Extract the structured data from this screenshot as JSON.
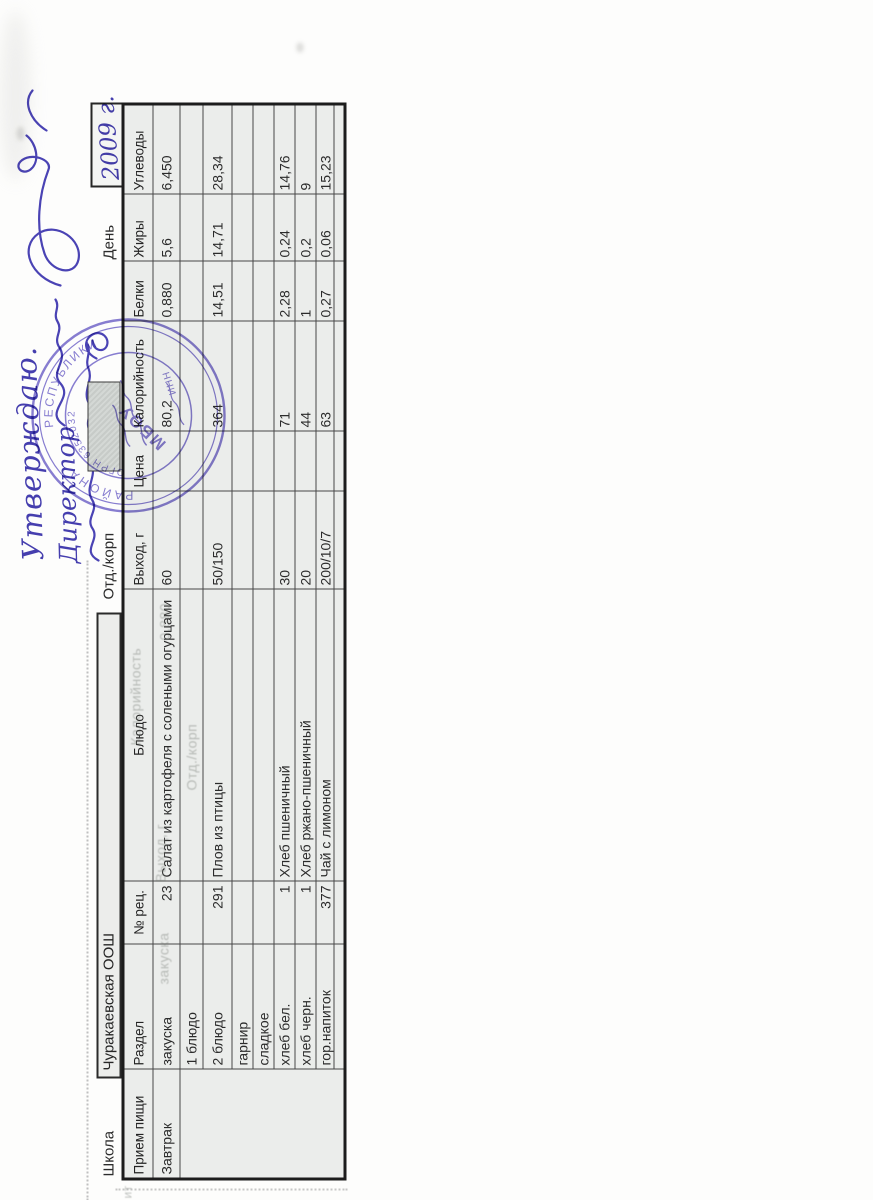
{
  "document": {
    "approval": {
      "approved_label": "Утверждаю.",
      "director_label": "Директор",
      "date_value": "2009 г."
    },
    "header": {
      "school_label": "Школа",
      "school_value": "Чуракаевская ООШ",
      "department_label": "Отд./корп",
      "day_label": "День"
    },
    "stamp": {
      "org_abbr": "МБОУ",
      "ring_text_1": "РАЙОНА",
      "ring_text_2": "РЕСПУБЛИКИ",
      "ogrn_text": "ОГРН 6352032",
      "inn_label": "ИНН"
    },
    "ghost_artifacts": {
      "g1": "Отд./корп",
      "g2": "Выход, г",
      "g3": "Калорийность",
      "g4": "0,880",
      "g5": "закуска",
      "g6": "ит"
    },
    "menu_table": {
      "headers": [
        "Прием пищи",
        "Раздел",
        "№ рец.",
        "Блюдо",
        "Выход, г",
        "Цена",
        "Калорийность",
        "Белки",
        "Жиры",
        "Углеводы"
      ],
      "rows": [
        [
          "Завтрак",
          "закуска",
          "23",
          "Салат из картофеля с солеными огурцами",
          "60",
          "",
          "80,2",
          "0,880",
          "5,6",
          "6,450"
        ],
        [
          "",
          "1 блюдо",
          "",
          "",
          "",
          "",
          "",
          "",
          "",
          ""
        ],
        [
          "",
          "2 блюдо",
          "291",
          "Плов из птицы",
          "50/150",
          "",
          "364",
          "14,51",
          "14,71",
          "28,34"
        ],
        [
          "",
          "гарнир",
          "",
          "",
          "",
          "",
          "",
          "",
          "",
          ""
        ],
        [
          "",
          "сладкое",
          "",
          "",
          "",
          "",
          "",
          "",
          "",
          ""
        ],
        [
          "",
          "хлеб бел.",
          "1",
          "Хлеб пшеничный",
          "30",
          "",
          "71",
          "2,28",
          "0,24",
          "14,76"
        ],
        [
          "",
          "хлеб черн.",
          "1",
          "Хлеб ржано-пшеничный",
          "20",
          "",
          "44",
          "1",
          "0,2",
          "9"
        ],
        [
          "",
          "гор.напиток",
          "377",
          "Чай с лимоном",
          "200/10/7",
          "",
          "63",
          "0,27",
          "0,06",
          "15,23"
        ],
        [
          "",
          "",
          "",
          "",
          "",
          "",
          "",
          "",
          "",
          ""
        ]
      ]
    }
  }
}
